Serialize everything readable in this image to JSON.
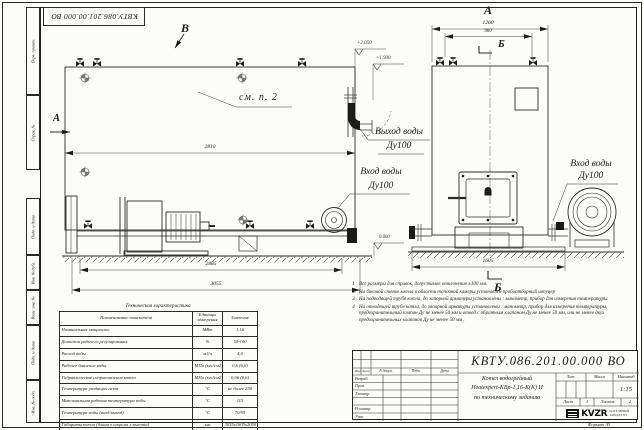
{
  "stamp_top": "КВТУ.086.201.00.000  ВО",
  "frame": {
    "left_labels": [
      "Перв. примен.",
      "Справ. №",
      "Подп. и дата",
      "Инв. № дубл.",
      "Взам. инв. №",
      "Подп. и дата",
      "Инв. № подл."
    ],
    "format_note": "Формат  А3"
  },
  "drawing": {
    "view_labels": {
      "a_top": "А",
      "a_left": "А",
      "b_top": "Б",
      "b_bottom": "Б",
      "v_top": "В"
    },
    "see_ref": "см. п. 2",
    "dimensions": {
      "side_width": "2810",
      "base_width": "2885",
      "total_length": "3055",
      "front_width": "1260",
      "front_inner": "960",
      "front_base": "1605"
    },
    "elevations": {
      "top": "+2.050",
      "mid": "+1.930",
      "zero": "0.000"
    },
    "ports": {
      "outlet_title": "Выход воды",
      "outlet_dn": "Ду100",
      "inlet_title": "Вход воды",
      "inlet_dn": "Ду100",
      "inlet2_title": "Вход воды",
      "inlet2_dn": "Ду100"
    }
  },
  "notes": {
    "items": [
      {
        "num": "1",
        "text": "Все размеры для справок, допустимое отклонение  ±100 мм."
      },
      {
        "num": "2",
        "text": "На боковой стенке котла в области топочной камеры установлен пробоотборный штуцер"
      },
      {
        "num": "3",
        "text": "На  подводящей трубе котла, до запорной арматуры установлены : манометр, прибор для измерения температуры."
      },
      {
        "num": "4",
        "text": "На отводящей трубе котла, до запорной арматуры установлены : манометр, прибор для измерения температуры, предохранительный клапан  Ду не менее 50 мм и отвод с обратным клапаном  Ду не менее 50 мм, или не менее двух предохранительных клапанов  Ду не менее 50 мм ."
      }
    ]
  },
  "spec_table": {
    "title": "Техническая характеристика",
    "headers": [
      "Наименование показателя",
      "Единицы измерения",
      "Значение"
    ],
    "rows": [
      [
        "Номинальная мощность",
        "МВт",
        "1,16"
      ],
      [
        "Диапазон рабочего регулирования",
        "%",
        "50-100"
      ],
      [
        "Расход воды",
        "м3/ч",
        "4,0"
      ],
      [
        "Рабочее давление воды",
        "МПа (кгс/см2)",
        "0,6 (6,0)"
      ],
      [
        "Гидравлическое сопротивление котла",
        "МПа (кгс/см2)",
        "0,06 (0,6)"
      ],
      [
        "Температура уходящих газов",
        "°С",
        "не более 250"
      ],
      [
        "Максимальная рабочая температура воды",
        "°С",
        "115"
      ],
      [
        "Температура воды (вход/выход)",
        "°С",
        "70/95"
      ],
      [
        "Габариты котла (длина х ширина х высота)",
        "мм",
        "3055х1605х2050"
      ]
    ]
  },
  "titleblock": {
    "doc_number": "КВТУ.086.201.00.000  ВО",
    "name_line1": "Котел водогрейный",
    "name_line2": "Heatexpert-КВр-1,16-К(К) И",
    "name_line3": "по техническому заданию",
    "sig_headers": [
      "Изм",
      "Лист",
      "N докум.",
      "Подп.",
      "Дата"
    ],
    "sig_rows": [
      "Разраб.",
      "Пров.",
      "Т.контр.",
      "Н.контр.",
      "Утв."
    ],
    "lit_label": "Лит.",
    "mass_label": "Масса",
    "scale_label": "Масштаб",
    "scale_value": "1:15",
    "sheet_label": "Лист",
    "sheet_value": "1",
    "sheets_label": "Листов",
    "sheets_value": "2",
    "logo_text": "KVZR",
    "logo_sub1": "КОТЕЛЬНЫЙ",
    "logo_sub2": "ЗАВОД РЭП"
  }
}
